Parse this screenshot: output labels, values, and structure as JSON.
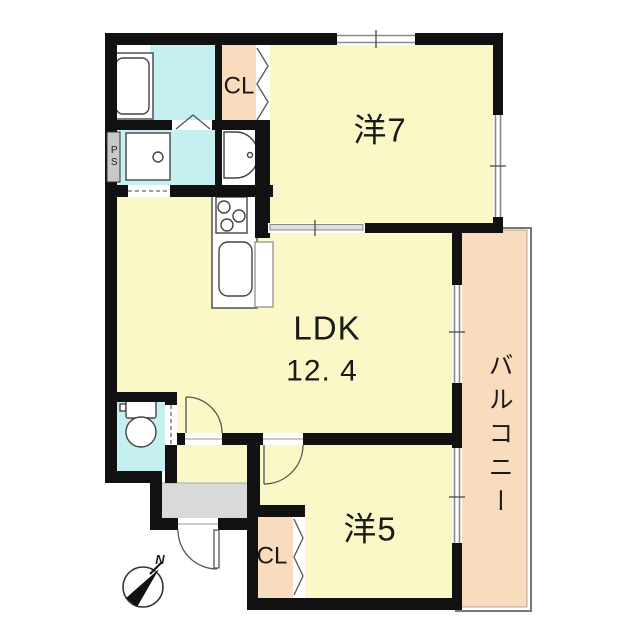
{
  "plan": {
    "type": "apartment-floorplan",
    "rooms": {
      "western7": "洋7",
      "ldk_name": "LDK",
      "ldk_size": "12. 4",
      "western5": "洋5",
      "balcony": "バルコニー",
      "closet_upper": "CL",
      "closet_lower": "CL",
      "pipe_space": "PS"
    },
    "compass_north": "N",
    "colors": {
      "room_fill": "#faf8c6",
      "wet_area_fill": "#c6eff2",
      "closet_fill": "#f9dcbd",
      "balcony_fill": "#f9dcbd",
      "entry_fill": "#d9d9d9",
      "wall": "#111111"
    }
  }
}
